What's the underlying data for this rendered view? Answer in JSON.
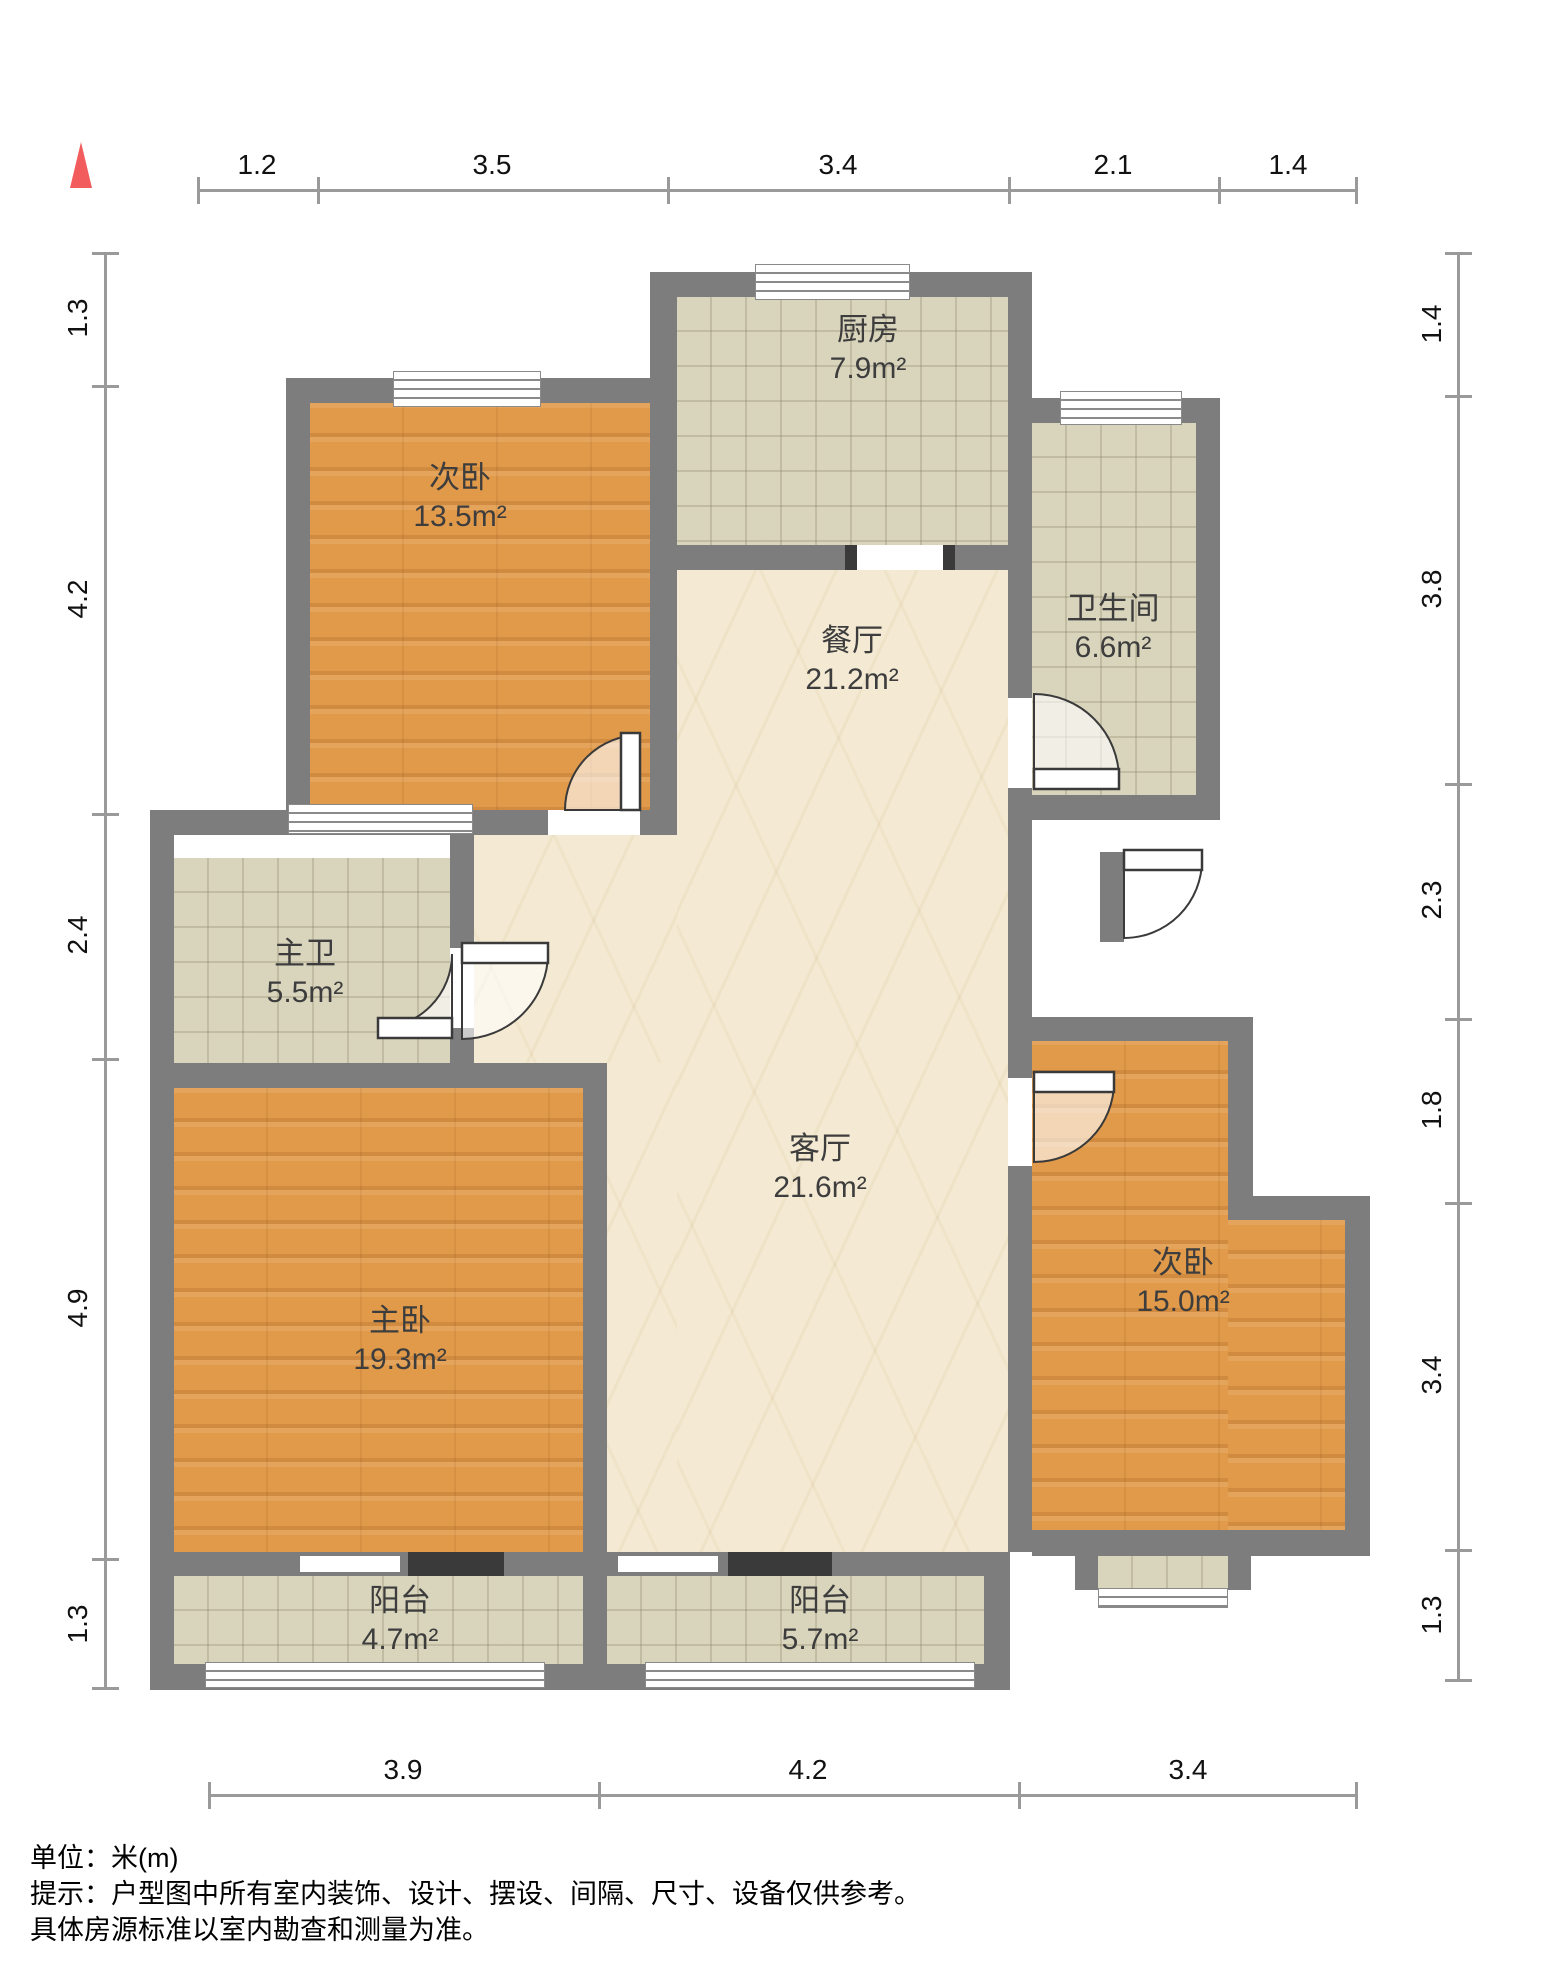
{
  "rooms": {
    "kitchen": {
      "name": "厨房",
      "area": "7.9m²"
    },
    "bedroom_top": {
      "name": "次卧",
      "area": "13.5m²"
    },
    "bathroom": {
      "name": "卫生间",
      "area": "6.6m²"
    },
    "dining": {
      "name": "餐厅",
      "area": "21.2m²"
    },
    "master_bath": {
      "name": "主卫",
      "area": "5.5m²"
    },
    "master_bedroom": {
      "name": "主卧",
      "area": "19.3m²"
    },
    "living": {
      "name": "客厅",
      "area": "21.6m²"
    },
    "bedroom_right": {
      "name": "次卧",
      "area": "15.0m²"
    },
    "balcony_left": {
      "name": "阳台",
      "area": "4.7m²"
    },
    "balcony_right": {
      "name": "阳台",
      "area": "5.7m²"
    }
  },
  "rulers": {
    "top": [
      "1.2",
      "3.5",
      "3.4",
      "2.1",
      "1.4"
    ],
    "left": [
      "1.3",
      "4.2",
      "2.4",
      "4.9",
      "1.3"
    ],
    "right": [
      "1.4",
      "3.8",
      "2.3",
      "1.8",
      "3.4",
      "1.3"
    ],
    "bottom": [
      "3.9",
      "4.2",
      "3.4"
    ]
  },
  "footer": {
    "line1": "单位：米(m)",
    "line2": "提示：户型图中所有室内装饰、设计、摆设、间隔、尺寸、设备仅供参考。",
    "line3": "具体房源标准以室内勘查和测量为准。"
  },
  "colors": {
    "wall": "#7D7D7D",
    "wood_floor": "#E19A4A",
    "tile_floor": "#D9D5BD",
    "marble_floor": "#F4EAD3",
    "north_arrow": "#F25C5C"
  }
}
